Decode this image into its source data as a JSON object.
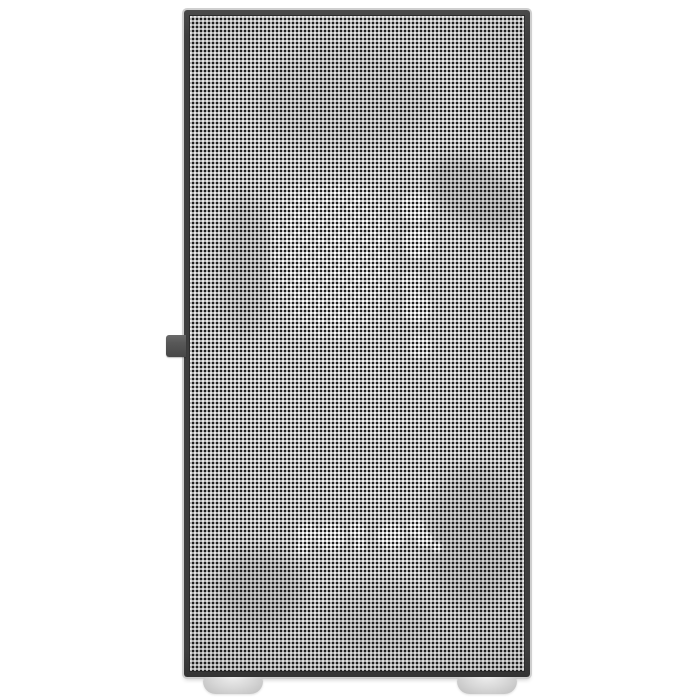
{
  "meta": {
    "description": "Front-view product photograph of a mini-tower PC case with a full perforated mesh front panel on a plain white background",
    "visible_text": "none"
  },
  "theme": {
    "background": "#ffffff",
    "case_frame": "#3e3e3e",
    "case_frame_edge": "#2b2b2b",
    "mesh_base": "#ebebeb",
    "mesh_dot": "#1b1b1b",
    "latch_tab": "#585858",
    "foot_light": "#ededed",
    "foot_dark": "#bdbdbd",
    "outer_highlight": "#cfcfcf"
  },
  "scene": {
    "background": "plain white studio background",
    "case": {
      "style": "mini tower with dark gray frame and full fine-dot mesh front panel",
      "side_tab": "small dark gray latch tab protruding from left edge at mid height",
      "feet": [
        "front-left rounded light-gray foot",
        "front-right rounded light-gray foot"
      ],
      "internal_glow": [
        "staggered grid of small white vent holes glowing through mesh, upper-left of center",
        "vertical chain of five white round cutouts glowing through mesh, upper-right of center",
        "faint white streaks mid panel",
        "horizontal row of bright white circles in lower-center",
        "soft dark shadows of internal components at upper-right, lower-left and lower-right"
      ]
    }
  }
}
